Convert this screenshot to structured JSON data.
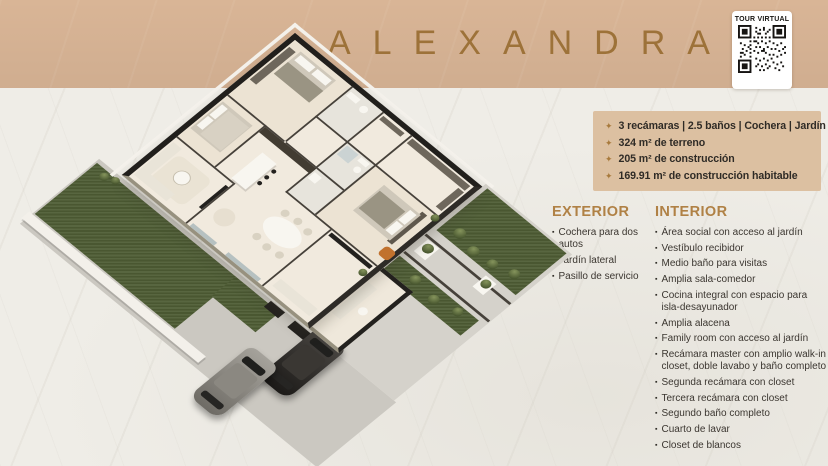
{
  "banner": {
    "title": "ALEXANDRA"
  },
  "qr": {
    "label": "TOUR VIRTUAL"
  },
  "bullets": {
    "diamond": "✦",
    "square": "▪"
  },
  "features": {
    "items": [
      "3 recámaras  |  2.5 baños  |  Cochera  |  Jardín",
      "324 m² de terreno",
      "205 m² de construcción",
      "169.91 m² de construcción habitable"
    ]
  },
  "exterior": {
    "heading": "EXTERIOR",
    "items": [
      "Cochera para dos autos",
      "Jardín lateral",
      "Pasillo de servicio"
    ]
  },
  "interior": {
    "heading": "INTERIOR",
    "items": [
      "Área social con acceso al jardín",
      "Vestíbulo recibidor",
      "Medio baño para visitas",
      "Amplia sala-comedor",
      "Cocina integral con espacio para isla-desayunador",
      "Amplia alacena",
      "Family room con acceso al jardín",
      "Recámara master con amplio walk-in closet, doble lavabo y baño completo",
      "Segunda recámara con closet",
      "Tercera recámara con closet",
      "Segundo baño completo",
      "Cuarto de lavar",
      "Closet de blancos"
    ]
  },
  "colors": {
    "banner_tan": "#d9b596",
    "band_tan": "#dcc0a1",
    "accent_gold": "#a87a3c",
    "heading_gold": "#b08145",
    "text_dark": "#3b3630",
    "lawn_green": "#4e5c34",
    "marble": "#efede7"
  }
}
